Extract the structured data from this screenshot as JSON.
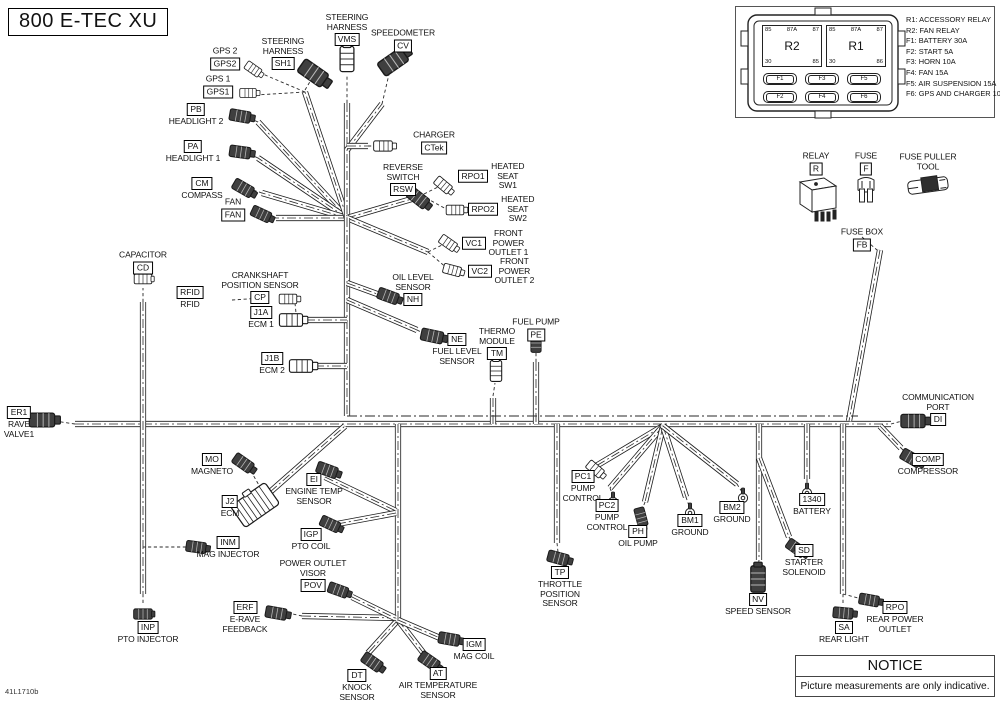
{
  "title": "800 E-TEC XU",
  "watermark": "41L1710b",
  "notice": {
    "header": "NOTICE",
    "body": "Picture measurements are only indicative."
  },
  "fuse_panel": {
    "legend": [
      "R1: ACCESSORY RELAY",
      "R2: FAN RELAY",
      "F1: BATTERY 30A",
      "F2: START 5A",
      "F3: HORN 10A",
      "F4: FAN 15A",
      "F5: AIR SUSPENSION 15A",
      "F6: GPS AND CHARGER 10A"
    ],
    "relays": [
      {
        "name": "R2",
        "pins_top": [
          "85",
          "87A",
          "87"
        ],
        "pins_bottom": [
          "30",
          "85"
        ]
      },
      {
        "name": "R1",
        "pins_top": [
          "85",
          "87A",
          "87"
        ],
        "pins_bottom": [
          "30",
          "86"
        ]
      }
    ],
    "fuses": [
      "F1",
      "F3",
      "F5",
      "F2",
      "F4",
      "F6"
    ]
  },
  "labels": [
    {
      "code": "GPS2",
      "text": "GPS 2",
      "pos": "above",
      "x": 225,
      "y": 62
    },
    {
      "code": "GPS1",
      "text": "GPS 1",
      "pos": "above",
      "x": 218,
      "y": 90
    },
    {
      "code": "PB",
      "text": "HEADLIGHT 2",
      "pos": "below",
      "x": 196,
      "y": 110
    },
    {
      "code": "PA",
      "text": "HEADLIGHT 1",
      "pos": "below",
      "x": 193,
      "y": 147
    },
    {
      "code": "CM",
      "text": "COMPASS",
      "pos": "below",
      "x": 202,
      "y": 184
    },
    {
      "code": "FAN",
      "text": "FAN",
      "pos": "above",
      "x": 233,
      "y": 213
    },
    {
      "code": "SH1",
      "text": "STEERING\nHARNESS",
      "pos": "above",
      "x": 283,
      "y": 62
    },
    {
      "code": "VMS",
      "text": "STEERING\nHARNESS",
      "pos": "above",
      "x": 347,
      "y": 38
    },
    {
      "code": "CV",
      "text": "SPEEDOMETER",
      "pos": "above",
      "x": 403,
      "y": 44
    },
    {
      "code": "CTek",
      "text": "CHARGER",
      "pos": "above",
      "x": 434,
      "y": 146
    },
    {
      "code": "RSW",
      "text": "REVERSE\nSWITCH",
      "pos": "above",
      "x": 403,
      "y": 188
    },
    {
      "code": "RPO1",
      "text": "HEATED\nSEAT\nSW1",
      "pos": "right",
      "x": 458,
      "y": 176
    },
    {
      "code": "RPO2",
      "text": "HEATED\nSEAT\nSW2",
      "pos": "right",
      "x": 468,
      "y": 209
    },
    {
      "code": "VC1",
      "text": "FRONT\nPOWER\nOUTLET 1",
      "pos": "right",
      "x": 462,
      "y": 243
    },
    {
      "code": "VC2",
      "text": "FRONT\nPOWER\nOUTLET 2",
      "pos": "right",
      "x": 468,
      "y": 271
    },
    {
      "code": "CD",
      "text": "CAPACITOR",
      "pos": "above",
      "x": 143,
      "y": 266
    },
    {
      "code": "CP",
      "text": "CRANKSHAFT\nPOSITION SENSOR",
      "pos": "above",
      "x": 260,
      "y": 296
    },
    {
      "code": "RFID",
      "text": "RFID",
      "pos": "below",
      "x": 190,
      "y": 293
    },
    {
      "code": "J1A",
      "text": "ECM 1",
      "pos": "below",
      "x": 261,
      "y": 313
    },
    {
      "code": "J1B",
      "text": "ECM 2",
      "pos": "below",
      "x": 272,
      "y": 359
    },
    {
      "code": "NH",
      "text": "OIL LEVEL\nSENSOR",
      "pos": "above",
      "x": 413,
      "y": 298
    },
    {
      "code": "NE",
      "text": "FUEL LEVEL\nSENSOR",
      "pos": "below",
      "x": 457,
      "y": 340
    },
    {
      "code": "TM",
      "text": "THERMO\nMODULE",
      "pos": "above",
      "x": 497,
      "y": 352
    },
    {
      "code": "PE",
      "text": "FUEL PUMP",
      "pos": "above",
      "x": 536,
      "y": 333
    },
    {
      "code": "ER1",
      "text": "RAVE\nVALVE1",
      "pos": "below",
      "x": 19,
      "y": 413
    },
    {
      "code": "MO",
      "text": "MAGNETO",
      "pos": "below",
      "x": 212,
      "y": 460
    },
    {
      "code": "J2",
      "text": "ECM",
      "pos": "below",
      "x": 230,
      "y": 502
    },
    {
      "code": "EI",
      "text": "ENGINE TEMP\nSENSOR",
      "pos": "below",
      "x": 314,
      "y": 480
    },
    {
      "code": "IGP",
      "text": "PTO COIL",
      "pos": "below",
      "x": 311,
      "y": 535
    },
    {
      "code": "INM",
      "text": "MAG INJECTOR",
      "pos": "below",
      "x": 228,
      "y": 543
    },
    {
      "code": "POV",
      "text": "POWER OUTLET\nVISOR",
      "pos": "above",
      "x": 313,
      "y": 584
    },
    {
      "code": "ERF",
      "text": "E-RAVE\nFEEDBACK",
      "pos": "below",
      "x": 245,
      "y": 608
    },
    {
      "code": "INP",
      "text": "PTO INJECTOR",
      "pos": "below",
      "x": 148,
      "y": 628
    },
    {
      "code": "DT",
      "text": "KNOCK\nSENSOR",
      "pos": "below",
      "x": 357,
      "y": 676
    },
    {
      "code": "AT",
      "text": "AIR TEMPERATURE\nSENSOR",
      "pos": "below",
      "x": 438,
      "y": 674
    },
    {
      "code": "IGM",
      "text": "MAG COIL",
      "pos": "below",
      "x": 474,
      "y": 645
    },
    {
      "code": "PC1",
      "text": "PUMP\nCONTROL",
      "pos": "below",
      "x": 583,
      "y": 477
    },
    {
      "code": "PC2",
      "text": "PUMP\nCONTROL",
      "pos": "below",
      "x": 607,
      "y": 506
    },
    {
      "code": "PH",
      "text": "OIL PUMP",
      "pos": "below",
      "x": 638,
      "y": 532
    },
    {
      "code": "BM1",
      "text": "GROUND",
      "pos": "below",
      "x": 690,
      "y": 521
    },
    {
      "code": "BM2",
      "text": "GROUND",
      "pos": "below",
      "x": 732,
      "y": 508
    },
    {
      "code": "TP",
      "text": "THROTTLE\nPOSITION\nSENSOR",
      "pos": "below",
      "x": 560,
      "y": 573
    },
    {
      "code": "1340",
      "text": "BATTERY",
      "pos": "below",
      "x": 812,
      "y": 500
    },
    {
      "code": "SD",
      "text": "STARTER\nSOLENOID",
      "pos": "below",
      "x": 804,
      "y": 551
    },
    {
      "code": "NV",
      "text": "SPEED SENSOR",
      "pos": "below",
      "x": 758,
      "y": 600
    },
    {
      "code": "SA",
      "text": "REAR LIGHT",
      "pos": "below",
      "x": 844,
      "y": 628
    },
    {
      "code": "RPO",
      "text": "REAR POWER\nOUTLET",
      "pos": "below",
      "x": 895,
      "y": 608
    },
    {
      "code": "DI",
      "text": "COMMUNICATION\nPORT",
      "pos": "above",
      "x": 938,
      "y": 418
    },
    {
      "code": "COMP",
      "text": "COMPRESSOR",
      "pos": "below",
      "x": 928,
      "y": 460
    },
    {
      "code": "FB",
      "text": "FUSE BOX",
      "pos": "above",
      "x": 862,
      "y": 243
    },
    {
      "code": "R",
      "text": "RELAY",
      "pos": "above",
      "x": 816,
      "y": 167
    },
    {
      "code": "F",
      "text": "FUSE",
      "pos": "above",
      "x": 866,
      "y": 167
    },
    {
      "code": null,
      "text": "FUSE PULLER\nTOOL",
      "pos": "none",
      "x": 928,
      "y": 162
    }
  ]
}
